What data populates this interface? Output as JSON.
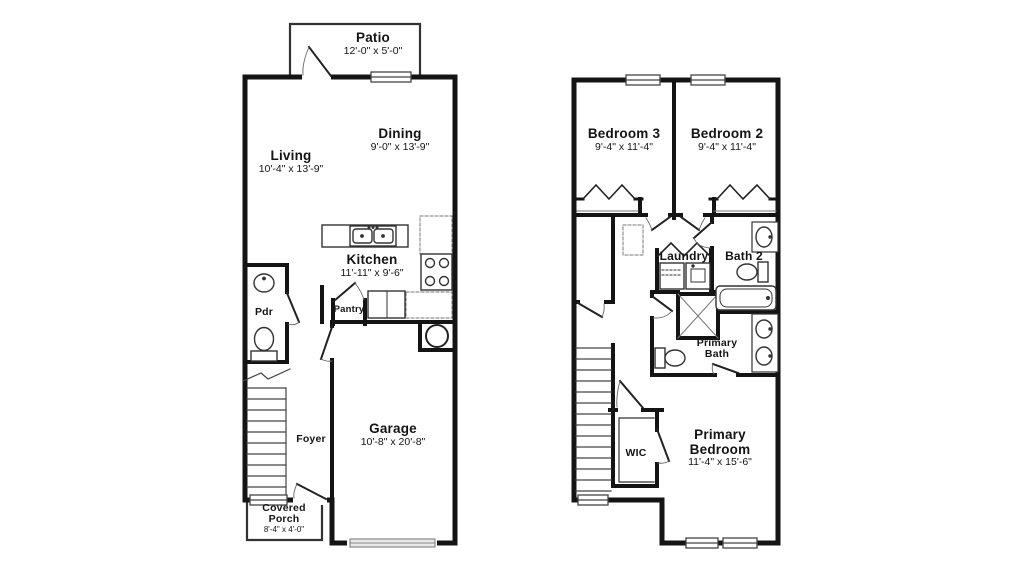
{
  "title": "Two-story townhome floor plan",
  "colors": {
    "wall": "#141414",
    "fixture": "#333333",
    "light_line": "#777777",
    "garage_door_fill": "#e9e9e9"
  },
  "floor1": {
    "rooms": {
      "patio": {
        "name": "Patio",
        "dims": "12'-0\" x 5'-0\""
      },
      "living": {
        "name": "Living",
        "dims": "10'-4\" x 13'-9\""
      },
      "dining": {
        "name": "Dining",
        "dims": "9'-0\" x 13'-9\""
      },
      "kitchen": {
        "name": "Kitchen",
        "dims": "11'-11\" x 9'-6\""
      },
      "pdr": {
        "name": "Pdr"
      },
      "pantry": {
        "name": "Pantry"
      },
      "foyer": {
        "name": "Foyer"
      },
      "garage": {
        "name": "Garage",
        "dims": "10'-8\" x 20'-8\""
      },
      "covered_porch": {
        "name_line1": "Covered",
        "name_line2": "Porch",
        "dims": "8'-4\" x 4'-0\""
      }
    }
  },
  "floor2": {
    "rooms": {
      "bedroom3": {
        "name": "Bedroom 3",
        "dims": "9'-4\" x 11'-4\""
      },
      "bedroom2": {
        "name": "Bedroom 2",
        "dims": "9'-4\" x 11'-4\""
      },
      "laundry": {
        "name": "Laundry"
      },
      "bath2": {
        "name": "Bath 2"
      },
      "primary_bath": {
        "name_line1": "Primary",
        "name_line2": "Bath"
      },
      "wic": {
        "name": "WIC"
      },
      "primary_bedroom": {
        "name_line1": "Primary",
        "name_line2": "Bedroom",
        "dims": "11'-4\" x 15'-6\""
      }
    }
  }
}
